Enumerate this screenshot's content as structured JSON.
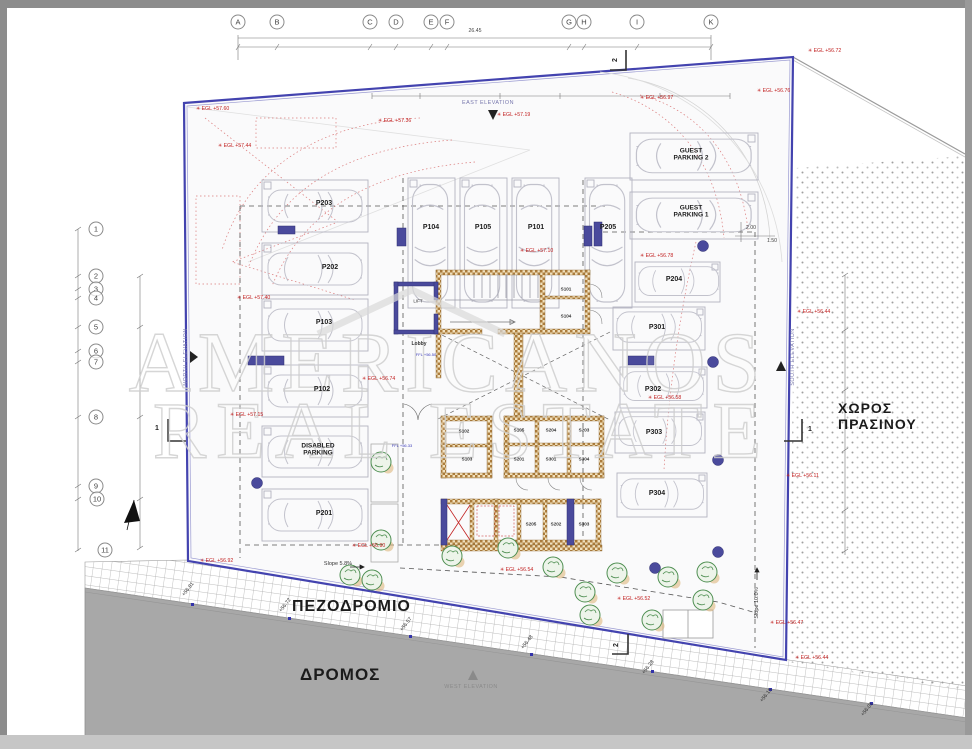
{
  "colors": {
    "boundary_blue": "#4343af",
    "annotation_red": "#c22222",
    "column_purple": "#4a4a9c",
    "wall_tan": "#ad7d3c",
    "road_gray": "#a8a8a8",
    "watermark_gray": "#cfcfcf"
  },
  "watermark": {
    "line1": "AMERICANOS",
    "line2": "REAL ESTATE"
  },
  "area_labels": {
    "sidewalk": "ΠΕΖΟΔΡΟΜΙΟ",
    "road": "ΔΡΟΜΟΣ",
    "green_space": "ΧΩΡΟΣ ΠΡΑΣΙΝΟΥ"
  },
  "grid": {
    "letters": [
      {
        "text": "A",
        "x": 238,
        "y": 22
      },
      {
        "text": "B",
        "x": 277,
        "y": 22
      },
      {
        "text": "C",
        "x": 370,
        "y": 22
      },
      {
        "text": "D",
        "x": 396,
        "y": 22
      },
      {
        "text": "E",
        "x": 431,
        "y": 22
      },
      {
        "text": "F",
        "x": 447,
        "y": 22
      },
      {
        "text": "G",
        "x": 569,
        "y": 22
      },
      {
        "text": "H",
        "x": 584,
        "y": 22
      },
      {
        "text": "I",
        "x": 637,
        "y": 22
      },
      {
        "text": "K",
        "x": 711,
        "y": 22
      }
    ],
    "numbers": [
      {
        "text": "1",
        "x": 96,
        "y": 229
      },
      {
        "text": "2",
        "x": 96,
        "y": 276
      },
      {
        "text": "3",
        "x": 96,
        "y": 289
      },
      {
        "text": "4",
        "x": 96,
        "y": 298
      },
      {
        "text": "5",
        "x": 96,
        "y": 327
      },
      {
        "text": "6",
        "x": 96,
        "y": 351
      },
      {
        "text": "7",
        "x": 96,
        "y": 362
      },
      {
        "text": "8",
        "x": 96,
        "y": 417
      },
      {
        "text": "9",
        "x": 96,
        "y": 486
      },
      {
        "text": "10",
        "x": 97,
        "y": 499
      },
      {
        "text": "11",
        "x": 105,
        "y": 550
      }
    ]
  },
  "parking_labels": [
    {
      "text": "P203",
      "x": 324,
      "y": 204
    },
    {
      "text": "P202",
      "x": 330,
      "y": 268
    },
    {
      "text": "P103",
      "x": 324,
      "y": 323
    },
    {
      "text": "P102",
      "x": 322,
      "y": 390
    },
    {
      "text": "DISABLED\nPARKING",
      "x": 318,
      "y": 450,
      "fs": 6.5
    },
    {
      "text": "P201",
      "x": 324,
      "y": 514
    },
    {
      "text": "P104",
      "x": 431,
      "y": 228
    },
    {
      "text": "P105",
      "x": 483,
      "y": 228
    },
    {
      "text": "P101",
      "x": 536,
      "y": 228
    },
    {
      "text": "P205",
      "x": 608,
      "y": 228
    },
    {
      "text": "GUEST\nPARKING 2",
      "x": 691,
      "y": 155,
      "fs": 6.5
    },
    {
      "text": "GUEST\nPARKING 1",
      "x": 691,
      "y": 212,
      "fs": 6.5
    },
    {
      "text": "P204",
      "x": 674,
      "y": 280
    },
    {
      "text": "P301",
      "x": 657,
      "y": 328
    },
    {
      "text": "P302",
      "x": 653,
      "y": 390
    },
    {
      "text": "P303",
      "x": 654,
      "y": 433
    },
    {
      "text": "P304",
      "x": 657,
      "y": 494
    }
  ],
  "storage_rooms": [
    {
      "text": "S101",
      "x": 566,
      "y": 289
    },
    {
      "text": "S104",
      "x": 566,
      "y": 316
    },
    {
      "text": "S102",
      "x": 464,
      "y": 431
    },
    {
      "text": "S103",
      "x": 467,
      "y": 459
    },
    {
      "text": "S105",
      "x": 519,
      "y": 430
    },
    {
      "text": "S204",
      "x": 551,
      "y": 430
    },
    {
      "text": "S203",
      "x": 584,
      "y": 430
    },
    {
      "text": "S201",
      "x": 519,
      "y": 459
    },
    {
      "text": "S301",
      "x": 551,
      "y": 459
    },
    {
      "text": "S304",
      "x": 584,
      "y": 459
    },
    {
      "text": "S205",
      "x": 531,
      "y": 524
    },
    {
      "text": "S202",
      "x": 556,
      "y": 524
    },
    {
      "text": "S303",
      "x": 584,
      "y": 524
    }
  ],
  "core_labels": [
    {
      "text": "LIFT",
      "x": 418,
      "y": 301,
      "fs": 4.5
    },
    {
      "text": "Lobby",
      "x": 419,
      "y": 345,
      "fs": 5,
      "bold": true
    },
    {
      "text": "FFL +56.50",
      "x": 426,
      "y": 355,
      "fs": 4,
      "color": "#3a3ab8"
    },
    {
      "text": "FFL +56.33",
      "x": 402,
      "y": 446,
      "fs": 4,
      "color": "#3a3ab8"
    }
  ],
  "egl_levels": [
    {
      "text": "EGL +57.60",
      "x": 196,
      "y": 110
    },
    {
      "text": "EGL +57.44",
      "x": 218,
      "y": 147
    },
    {
      "text": "EGL +57.36",
      "x": 378,
      "y": 122
    },
    {
      "text": "EGL +57.19",
      "x": 497,
      "y": 116
    },
    {
      "text": "EGL +56.97",
      "x": 640,
      "y": 99
    },
    {
      "text": "EGL +56.76",
      "x": 757,
      "y": 92
    },
    {
      "text": "EGL +56.72",
      "x": 808,
      "y": 52
    },
    {
      "text": "EGL +57.10",
      "x": 520,
      "y": 252
    },
    {
      "text": "EGL +57.40",
      "x": 237,
      "y": 299
    },
    {
      "text": "EGL +56.78",
      "x": 640,
      "y": 257
    },
    {
      "text": "EGL +57.15",
      "x": 230,
      "y": 416
    },
    {
      "text": "EGL +56.74",
      "x": 362,
      "y": 380
    },
    {
      "text": "EGL +56.58",
      "x": 648,
      "y": 399
    },
    {
      "text": "EGL +56.44",
      "x": 797,
      "y": 313
    },
    {
      "text": "EGL +56.11",
      "x": 786,
      "y": 477
    },
    {
      "text": "EGL +56.92",
      "x": 200,
      "y": 562
    },
    {
      "text": "EGL +56.90",
      "x": 352,
      "y": 547
    },
    {
      "text": "EGL +56.54",
      "x": 500,
      "y": 571
    },
    {
      "text": "EGL +56.52",
      "x": 617,
      "y": 600
    },
    {
      "text": "EGL +56.47",
      "x": 770,
      "y": 624
    },
    {
      "text": "EGL +56.44",
      "x": 795,
      "y": 659
    }
  ],
  "spot_levels": [
    {
      "text": "+56.81",
      "x": 189,
      "y": 590,
      "rot": -52
    },
    {
      "text": "+56.72",
      "x": 286,
      "y": 606,
      "rot": -52
    },
    {
      "text": "+56.57",
      "x": 407,
      "y": 625,
      "rot": -52
    },
    {
      "text": "+56.48",
      "x": 528,
      "y": 643,
      "rot": -52
    },
    {
      "text": "+56.28",
      "x": 649,
      "y": 668,
      "rot": -52
    },
    {
      "text": "+56.15",
      "x": 767,
      "y": 696,
      "rot": -52
    },
    {
      "text": "+56.01",
      "x": 868,
      "y": 710,
      "rot": -52
    }
  ],
  "slope_labels": [
    {
      "text": "Slope 5.8%",
      "x": 338,
      "y": 564
    },
    {
      "text": "Slope 10.0%",
      "x": 757,
      "y": 603,
      "rot": -90
    }
  ],
  "elevation_markers": [
    {
      "text": "EAST ELEVATION",
      "x": 488,
      "y": 103
    },
    {
      "text": "NORTH ELEVATION",
      "x": 186,
      "y": 357,
      "rot": -90
    },
    {
      "text": "SOUTH ELEVATION",
      "x": 793,
      "y": 357,
      "rot": -90
    },
    {
      "text": "WEST ELEVATION",
      "x": 471,
      "y": 687,
      "color": "#8a8a8a"
    }
  ],
  "section_markers": [
    {
      "text": "1",
      "x": 157,
      "y": 429
    },
    {
      "text": "1",
      "x": 810,
      "y": 430
    },
    {
      "text": "2",
      "x": 616,
      "y": 60,
      "rot": -90
    },
    {
      "text": "2",
      "x": 617,
      "y": 645,
      "rot": -90
    }
  ],
  "dimensions": [
    {
      "text": "26.45",
      "x": 475,
      "y": 32
    },
    {
      "text": "2.00",
      "x": 751,
      "y": 229
    },
    {
      "text": "1.50",
      "x": 772,
      "y": 242
    }
  ]
}
